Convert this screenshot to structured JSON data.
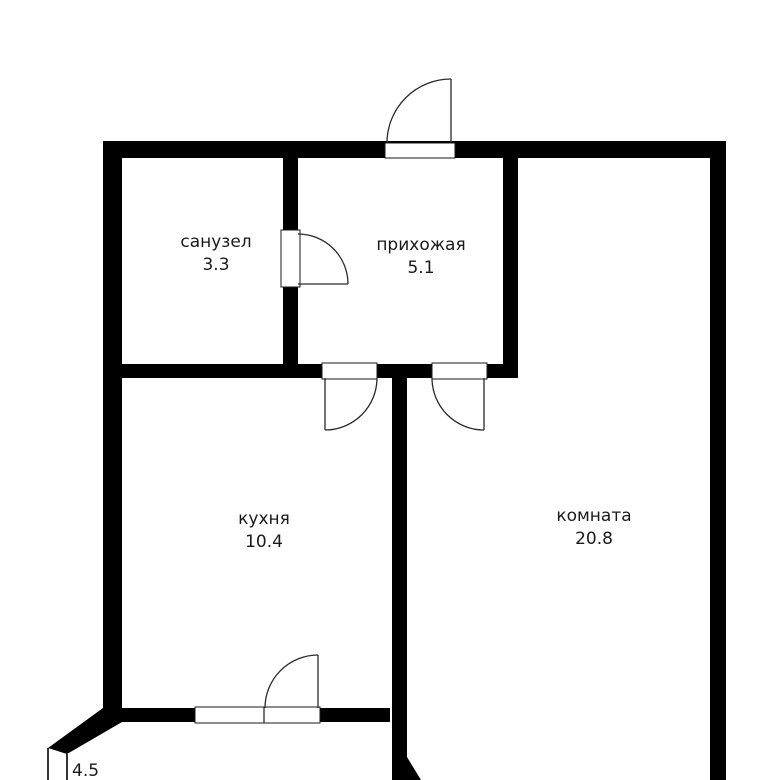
{
  "floorplan": {
    "width": 774,
    "height": 780,
    "colors": {
      "background": "#ffffff",
      "wall": "#000000",
      "door_line": "#2a2a2a",
      "opening_outline": "#1a1a1a",
      "text": "#1a1a1a"
    },
    "rooms": [
      {
        "id": "sanuzel",
        "name": "санузел",
        "area": "3.3",
        "cx": 216,
        "name_y": 247,
        "area_y": 270,
        "anchor": "middle"
      },
      {
        "id": "prihozhaya",
        "name": "прихожая",
        "area": "5.1",
        "cx": 421,
        "name_y": 250,
        "area_y": 273,
        "anchor": "middle"
      },
      {
        "id": "kuhnya",
        "name": "кухня",
        "area": "10.4",
        "cx": 264,
        "name_y": 524,
        "area_y": 547,
        "anchor": "middle"
      },
      {
        "id": "komnata",
        "name": "комната",
        "area": "20.8",
        "cx": 594,
        "name_y": 521,
        "area_y": 544,
        "anchor": "middle"
      },
      {
        "id": "balkon",
        "name": "",
        "area": "4.5",
        "cx": 72,
        "name_y": 0,
        "area_y": 776,
        "anchor": "start"
      }
    ],
    "walls": [
      {
        "id": "top-wall",
        "x": 103,
        "y": 141,
        "w": 623,
        "h": 17
      },
      {
        "id": "left-wall",
        "x": 103,
        "y": 141,
        "w": 19,
        "h": 567
      },
      {
        "id": "right-wall",
        "x": 710,
        "y": 141,
        "w": 16,
        "h": 639
      },
      {
        "id": "bath-hall-wall",
        "x": 283,
        "y": 158,
        "w": 15,
        "h": 219
      },
      {
        "id": "mid-wall",
        "x": 103,
        "y": 364,
        "w": 415,
        "h": 14
      },
      {
        "id": "hall-room-wall",
        "x": 503,
        "y": 158,
        "w": 15,
        "h": 220
      },
      {
        "id": "kitchen-room-wall",
        "x": 392,
        "y": 378,
        "w": 15,
        "h": 402
      },
      {
        "id": "kitchen-bottom-wall",
        "x": 122,
        "y": 708,
        "w": 268,
        "h": 14
      }
    ],
    "wall_polygons": [
      {
        "id": "balcony-corner",
        "points": "103,708 122,708 122,722 67,754 48,748"
      },
      {
        "id": "divider-bottom-flare",
        "points": "407,757 421,780 407,780"
      }
    ],
    "openings": [
      {
        "id": "entrance-opening",
        "x": 385,
        "y": 143,
        "w": 70,
        "h": 15
      },
      {
        "id": "bath-door-opening",
        "x": 281,
        "y": 230,
        "w": 19,
        "h": 57
      },
      {
        "id": "kitchen-door-opening",
        "x": 322,
        "y": 363,
        "w": 55,
        "h": 16
      },
      {
        "id": "room-door-opening",
        "x": 432,
        "y": 363,
        "w": 55,
        "h": 16
      },
      {
        "id": "kitchen-window-block",
        "x": 195,
        "y": 707,
        "w": 125,
        "h": 16
      }
    ],
    "window_dividers": [
      {
        "id": "window-door-divider",
        "x1": 264,
        "y1": 707,
        "x2": 264,
        "y2": 723
      }
    ],
    "doors": [
      {
        "id": "entrance-door",
        "leaf": "M451 143 L451 79",
        "arc": "M451 79 A64 64 0 0 0 387 143"
      },
      {
        "id": "bath-door",
        "leaf": "M298 284 L348 284",
        "arc": "M298 234 A50 50 0 0 1 348 284"
      },
      {
        "id": "kitchen-door",
        "leaf": "M325 378 L325 430",
        "arc": "M377 378 A52 52 0 0 1 325 430"
      },
      {
        "id": "room-door",
        "leaf": "M484 378 L484 430",
        "arc": "M432 378 A52 52 0 0 0 484 430"
      },
      {
        "id": "balcony-door",
        "leaf": "M318 708 L318 655",
        "arc": "M318 655 A53 53 0 0 0 265 708"
      }
    ],
    "balcony_lines": [
      {
        "id": "balcony-outer-line",
        "x1": 48,
        "y1": 748,
        "x2": 48,
        "y2": 780
      },
      {
        "id": "balcony-inner-line",
        "x1": 67,
        "y1": 754,
        "x2": 67,
        "y2": 780
      }
    ]
  }
}
